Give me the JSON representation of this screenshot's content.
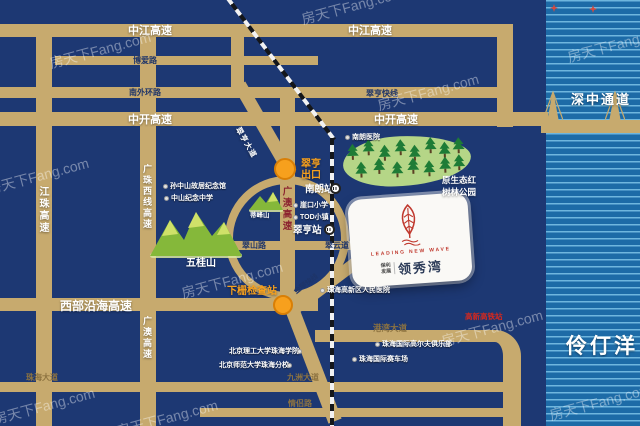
{
  "watermark": "房天下Fang.com",
  "sea": {
    "label": "伶仃洋"
  },
  "bridge": {
    "label": "深中通道"
  },
  "highways": {
    "zhongjiang": "中江高速",
    "zhongkai": "中开高速",
    "jiangzhu": "江珠高速",
    "guangzhu_west": "广珠西线高速",
    "guangao": "广澳高速",
    "west_coastal": "西部沿海高速",
    "cuiheng_express": "翠亨快线",
    "jinqin_express": "金琴快线"
  },
  "roads": {
    "boai": "博爱路",
    "south_ring": "南外环路",
    "cuiheng_avenue": "翠亨大道",
    "cuishan": "翠山路",
    "cuiyun": "翠云道",
    "zhuhai_avenue": "珠海大道",
    "jiuzhou_avenue": "九洲大道",
    "qinglv": "情侣路",
    "gangwan_avenue": "港湾大道"
  },
  "stations": {
    "nanlang": "南朗站",
    "cuiheng": "翠亨站"
  },
  "exits": {
    "cuiheng_exit_line1": "翠亨",
    "cuiheng_exit_line2": "出口",
    "xiazha_checkpoint": "下栅检查站"
  },
  "pois": {
    "sun_yatsen_memorial": "孙中山故居纪念馆",
    "zhongshan_memorial_school": "中山纪念中学",
    "nanlang_hospital": "南朗医院",
    "yakou_primary": "崖口小学",
    "tod_town": "TOD小镇",
    "gaoxin_hospital": "珠海高新区人民医院",
    "bit_zhuhai": "北京理工大学珠海学院",
    "bnu_zhuhai": "北京师范大学珠海分校",
    "intl_golf": "珠海国际高尔夫俱乐部",
    "intl_circuit": "珠海国际赛车场",
    "planned_station": "高新高铁站"
  },
  "nature": {
    "wugui_mountain": "五桂山",
    "difeng_mountain": "蒂峰山",
    "mangrove_park_line1": "原生态红",
    "mangrove_park_line2": "树林公园"
  },
  "property": {
    "brand_line1": "保利",
    "brand_line2": "发展",
    "tagline": "LEADING NEW WAVE",
    "name": "领秀湾"
  },
  "colors": {
    "land": "#1d3873",
    "road": "#c7aa6e",
    "water": "#1d6ba7",
    "accent_orange": "#f7a01d",
    "highway_maroon": "#8c2430",
    "planned_red": "#d6281e",
    "logo_red": "#c0392e"
  }
}
